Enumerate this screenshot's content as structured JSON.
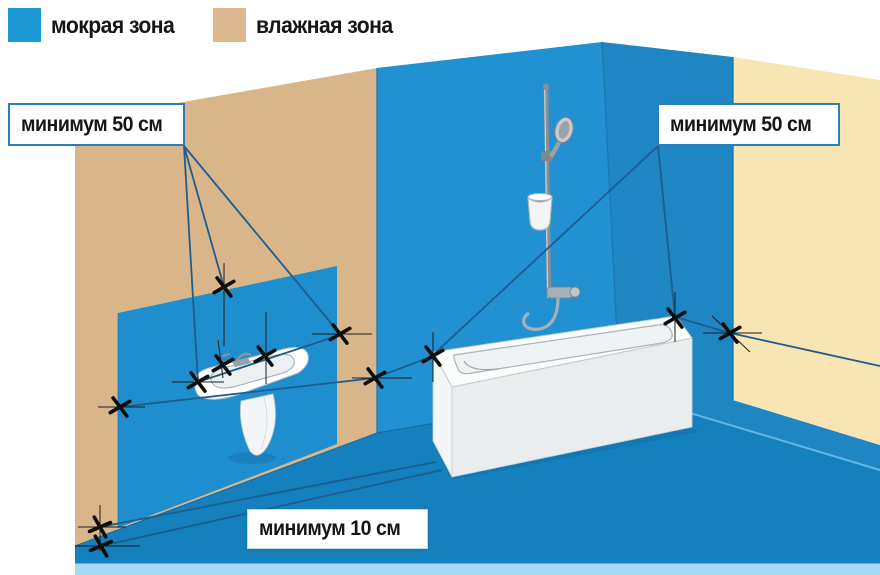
{
  "legend": {
    "items": [
      {
        "name": "wet-zone",
        "label": "мокрая зона",
        "color": "#1b9ad6"
      },
      {
        "name": "damp-zone",
        "label": "влажная зона",
        "color": "#dcb88e"
      }
    ]
  },
  "callouts": {
    "left": "минимум 50 см",
    "right": "минимум 50 см",
    "bottom": "минимум 10 см"
  },
  "scene_colors": {
    "wet_wall_back": "#2191d2",
    "wet_wall_right": "#1f86c4",
    "wet_wall_panel": "#1f8ecf",
    "wet_floor": "#1480bd",
    "damp_wall": "#d9b68a",
    "damp_wall_light": "#f9e4b4",
    "measure_line": "#1c5d8f"
  }
}
